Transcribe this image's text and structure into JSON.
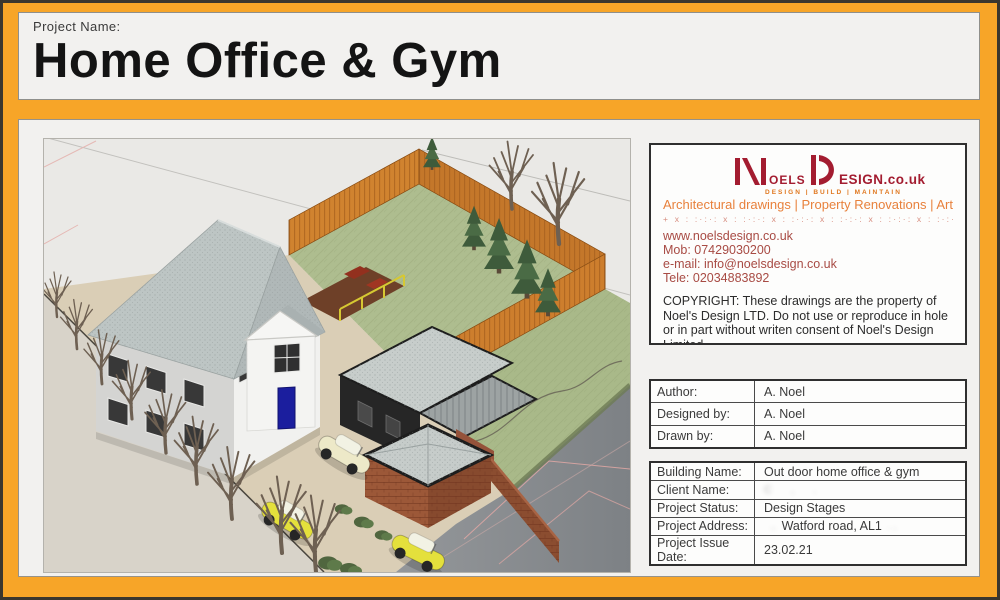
{
  "page": {
    "frame_color": "#F7A528",
    "panel_color": "#F2F1EF",
    "edge_color": "#3A362E"
  },
  "header": {
    "label": "Project Name:",
    "title": "Home Office & Gym"
  },
  "branding": {
    "logo": {
      "oels": "OELS",
      "esign": "ESIGN.co.uk",
      "sub": "DESIGN | BUILD | MAINTAIN",
      "red": "#A31C30",
      "orange": "#E0771E"
    },
    "tagline": "Architectural drawings | Property Renovations | Art",
    "divider_glyphs": "+ x : :·:·: x : :·:·: x : :·:·: x : :·:·: x : :·:·: x : :·:·: x : :·:·: x",
    "website": "www.noelsdesign.co.uk",
    "mobile": "Mob:  07429030200",
    "email": "e-mail: info@noelsdesign.co.uk",
    "telephone": "Tele: 02034883892",
    "copyright": "COPYRIGHT: These drawings are the property of Noel's Design LTD.  Do not use or reproduce in hole or in part without writen consent of Noel's Design Limited."
  },
  "credits": {
    "rows": [
      {
        "label": "Author:",
        "value": "A. Noel"
      },
      {
        "label": "Designed by:",
        "value": "A. Noel"
      },
      {
        "label": "Drawn by:",
        "value": "A. Noel"
      }
    ]
  },
  "project": {
    "rows": [
      {
        "label": "Building Name:",
        "value": "Out door home office & gym"
      },
      {
        "label": "Client Name:",
        "value": "",
        "redacted": true
      },
      {
        "label": "Project Status:",
        "value": "Design Stages"
      },
      {
        "label": "Project Address:",
        "value": "Watford road, AL1",
        "redacted_partial": true
      },
      {
        "label": "Project Issue Date:",
        "value": "23.02.21"
      }
    ]
  },
  "scene": {
    "description": "Isometric 3D site render: white detached house with grey hipped roof and blue door, dark-clad outdoor home office & gym with grey roofs, brick garden store, orange timber fence around lawn, driveway with yellow cars, bare street trees",
    "palette": {
      "fence": "#D0832F",
      "garden_lawn": "#AEBD8F",
      "house_roof": "#BDC5C4",
      "house_wall": "#F1F1EF",
      "office_wall": "#262626",
      "brick": "#9C5838",
      "road": "#8F9295",
      "driveway": "#DACEB6",
      "car_yellow": "#E4E03C",
      "front_door": "#1B1E9E"
    }
  }
}
